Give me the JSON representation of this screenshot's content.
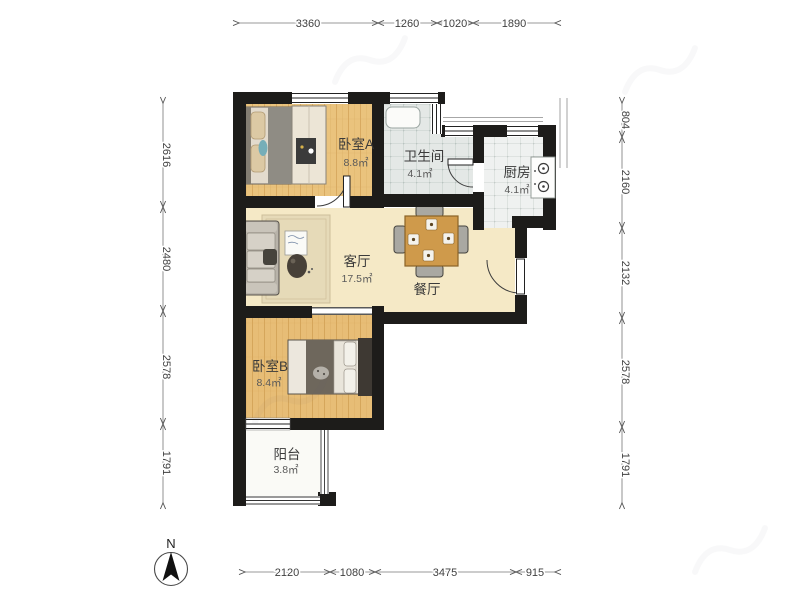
{
  "compass": {
    "label": "N"
  },
  "rooms": {
    "bedroomA": {
      "name": "卧室A",
      "area": "8.8㎡"
    },
    "bathroom": {
      "name": "卫生间",
      "area": "4.1㎡"
    },
    "kitchen": {
      "name": "厨房",
      "area": "4.1㎡"
    },
    "living": {
      "name": "客厅",
      "area": "17.5㎡"
    },
    "dining": {
      "name": "餐厅"
    },
    "bedroomB": {
      "name": "卧室B",
      "area": "8.4㎡"
    },
    "balcony": {
      "name": "阳台",
      "area": "3.8㎡"
    }
  },
  "dimensions": {
    "top": [
      {
        "label": "3360"
      },
      {
        "label": "1260"
      },
      {
        "label": "1020"
      },
      {
        "label": "1890"
      }
    ],
    "bottom": [
      {
        "label": "2120"
      },
      {
        "label": "1080"
      },
      {
        "label": "3475"
      },
      {
        "label": "915"
      }
    ],
    "left": [
      {
        "label": "2616"
      },
      {
        "label": "2480"
      },
      {
        "label": "2578"
      },
      {
        "label": "1791"
      }
    ],
    "right": [
      {
        "label": "804"
      },
      {
        "label": "2160"
      },
      {
        "label": "2132"
      },
      {
        "label": "2578"
      },
      {
        "label": "1791"
      }
    ]
  },
  "colors": {
    "wall": "#1d1c1a",
    "wood_floor": "#eac37d",
    "hall_floor": "#f5e9c6",
    "bath_tile": "#e4e8e6",
    "kitchen_tile": "#eff1f0",
    "balcony_floor": "#fafaf6"
  }
}
